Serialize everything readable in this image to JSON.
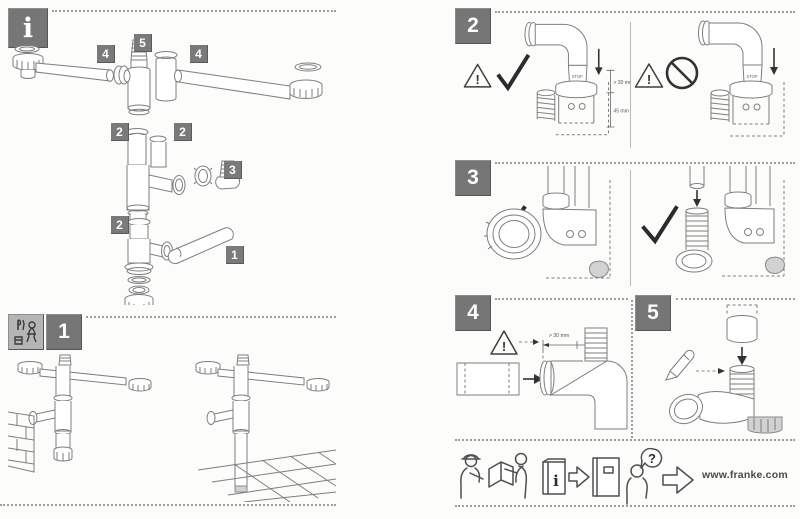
{
  "brand": {
    "website": "www.franke.com"
  },
  "info_panel": {
    "icon_label": "i",
    "part_badges": [
      "4",
      "5",
      "4",
      "2",
      "2",
      "3",
      "2",
      "1"
    ]
  },
  "steps": {
    "one": "1",
    "two": "2",
    "three": "3",
    "four": "4",
    "five": "5"
  },
  "step2": {
    "stop_label": "STOP",
    "dim_insertion": "> 30 mm",
    "dim_total": "45 mm"
  },
  "step4": {
    "dim_min": "> 30 mm",
    "dim_length": "50 mm"
  },
  "icons": {
    "warning_exclamation": "!",
    "names": [
      "info-icon",
      "tools-icon",
      "warning-icon",
      "check-icon",
      "prohibition-icon",
      "arrow-down-icon",
      "arrow-right-icon",
      "pencil-icon",
      "handover-icon",
      "manual-icon",
      "question-icon"
    ]
  },
  "pictograms": {
    "info_booklet_label": "i",
    "question_mark": "?"
  }
}
